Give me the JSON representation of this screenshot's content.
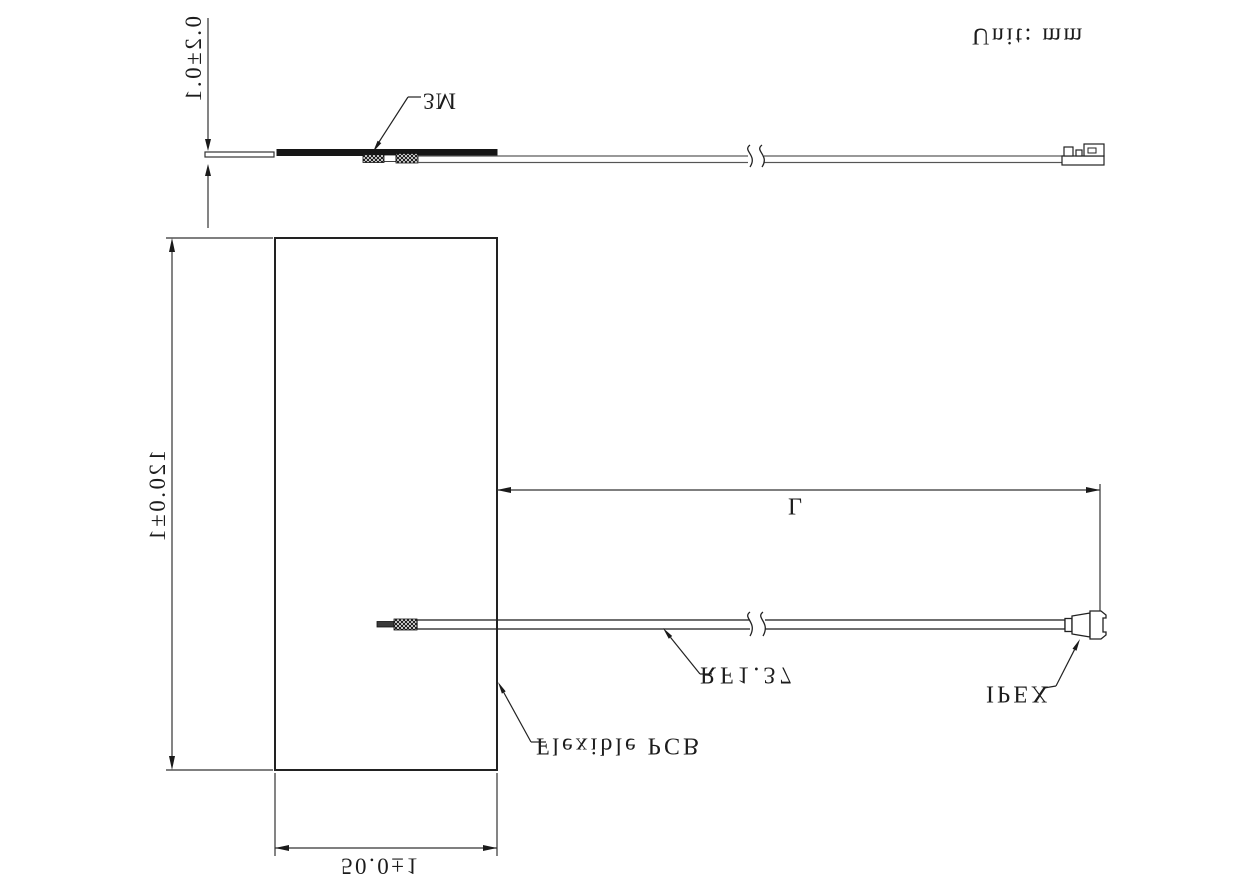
{
  "drawing": {
    "title": "Flexible PCB antenna outline drawing",
    "unit_label": "Unit: mm",
    "orientation": "mirrored-vertically",
    "side_view": {
      "thickness_dim": "0.2±0.1",
      "tape_label": "3M"
    },
    "front_view": {
      "height_dim": "120.0±1",
      "width_dim": "50.0±1",
      "length_dim": "L",
      "cable_label": "RF1.37",
      "connector_label": "IPEX",
      "board_label": "Flexible PCB"
    },
    "colors": {
      "line": "#222222",
      "fill_dark": "#161616",
      "background": "#ffffff"
    }
  }
}
